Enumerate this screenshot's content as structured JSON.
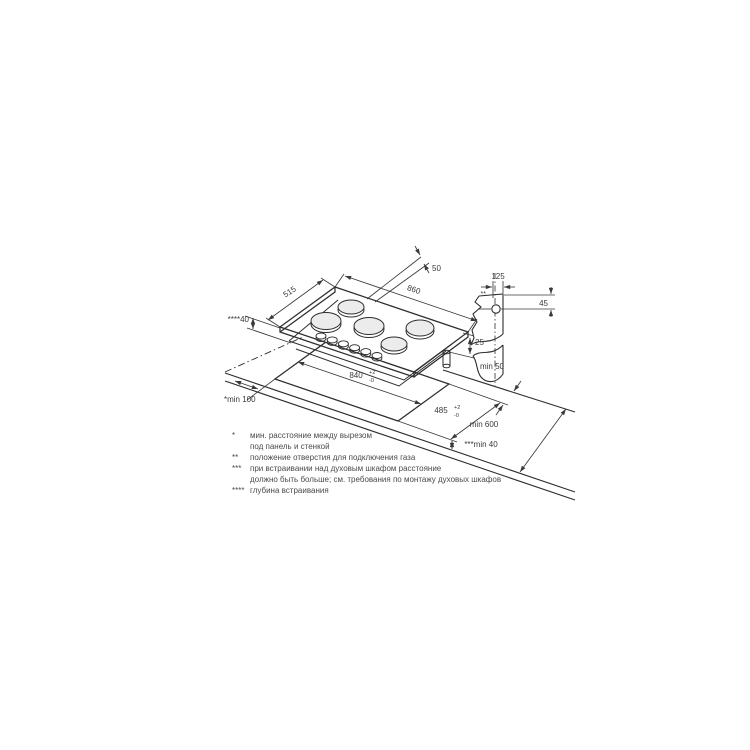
{
  "diagram": {
    "type": "gas-hob-installation-drawing",
    "colors": {
      "line": "#2e2e2e",
      "dim_line": "#3a3a3a",
      "burner_fill": "#ececec",
      "background": "#ffffff"
    },
    "hob": {
      "burner_count": 5,
      "knob_count": 6
    },
    "labels": {
      "gas_offset_top": "50",
      "hob_width": "860",
      "hob_depth": "515",
      "embed_depth": "****40",
      "hob_height": "25",
      "hole_offset_x": "125",
      "hole_offset_y": "45",
      "hole_marker": "**",
      "cutout_width": "840",
      "cutout_depth": "485",
      "tol_plus": "+2",
      "tol_minus": "-0",
      "back_clearance": "min 50",
      "worktop_depth": "min 600",
      "side_clearance": "*min 100",
      "front_clearance": "***min 40"
    },
    "footnotes": [
      {
        "marker": "*",
        "text": "мин. расстояние между вырезом"
      },
      {
        "marker": "",
        "text": "под панель и стенкой"
      },
      {
        "marker": "**",
        "text": "положение отверстия для подключения газа"
      },
      {
        "marker": "***",
        "text": "при встраивании над духовым шкафом расстояние"
      },
      {
        "marker": "",
        "text": "должно быть больше; см. требования по монтажу духовых шкафов"
      },
      {
        "marker": "****",
        "text": "глубина встраивания"
      }
    ]
  }
}
